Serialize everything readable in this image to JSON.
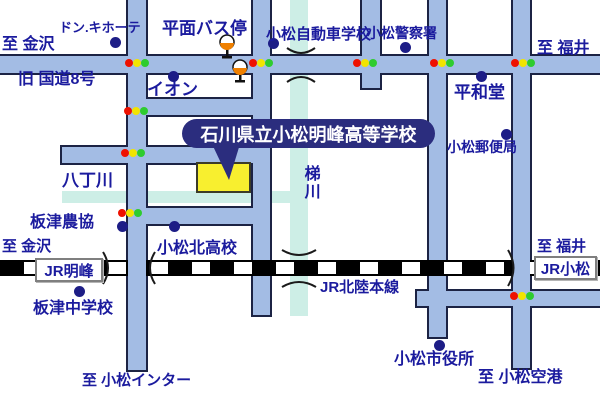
{
  "callout": {
    "school_name": "石川県立小松明峰高等学校"
  },
  "roads": {
    "route8": "旧 国道8号"
  },
  "railway": {
    "line_name": "JR北陸本線",
    "stations": {
      "meiho": "JR明峰",
      "komatsu": "JR小松"
    }
  },
  "rivers": {
    "haccho": "八丁川",
    "kakehashi": "梯川"
  },
  "directions": {
    "kanazawa_top": "至 金沢",
    "fukui_top": "至 福井",
    "kanazawa_left": "至 金沢",
    "fukui_right": "至 福井",
    "komatsu_inter": "至 小松インター",
    "komatsu_airport": "至 小松空港"
  },
  "pois": {
    "donki": "ドン.キホーテ",
    "bus_stop": "平面バス停",
    "driving_school": "小松自動車学校",
    "police": "小松警察署",
    "heiwado": "平和堂",
    "aeon": "イオン",
    "post_office": "小松郵便局",
    "itazu_nokyo": "板津農協",
    "komatsu_kita": "小松北高校",
    "itazu_jhs": "板津中学校",
    "city_hall": "小松市役所"
  },
  "icons": {
    "traffic_signal": "red-yellow-green-dots",
    "bus_stop_sign": "pole-with-orange-circle",
    "poi_marker": "filled-navy-circle",
    "rail_crossing": "paren-arc",
    "bridge": "pinch-arc"
  },
  "colors": {
    "road": "#a3bce4",
    "road_border": "#1c2344",
    "river": "#cdeee6",
    "text": "#1b1b9e",
    "poi_dot": "#1d1d86",
    "callout_bg": "#2b2d7e",
    "callout_text": "#ffffff",
    "school_fill": "#f8ef2f",
    "signal_red": "#ee1100",
    "signal_yellow": "#f2e400",
    "signal_green": "#2ecc2e",
    "bus_orange": "#f08000"
  }
}
